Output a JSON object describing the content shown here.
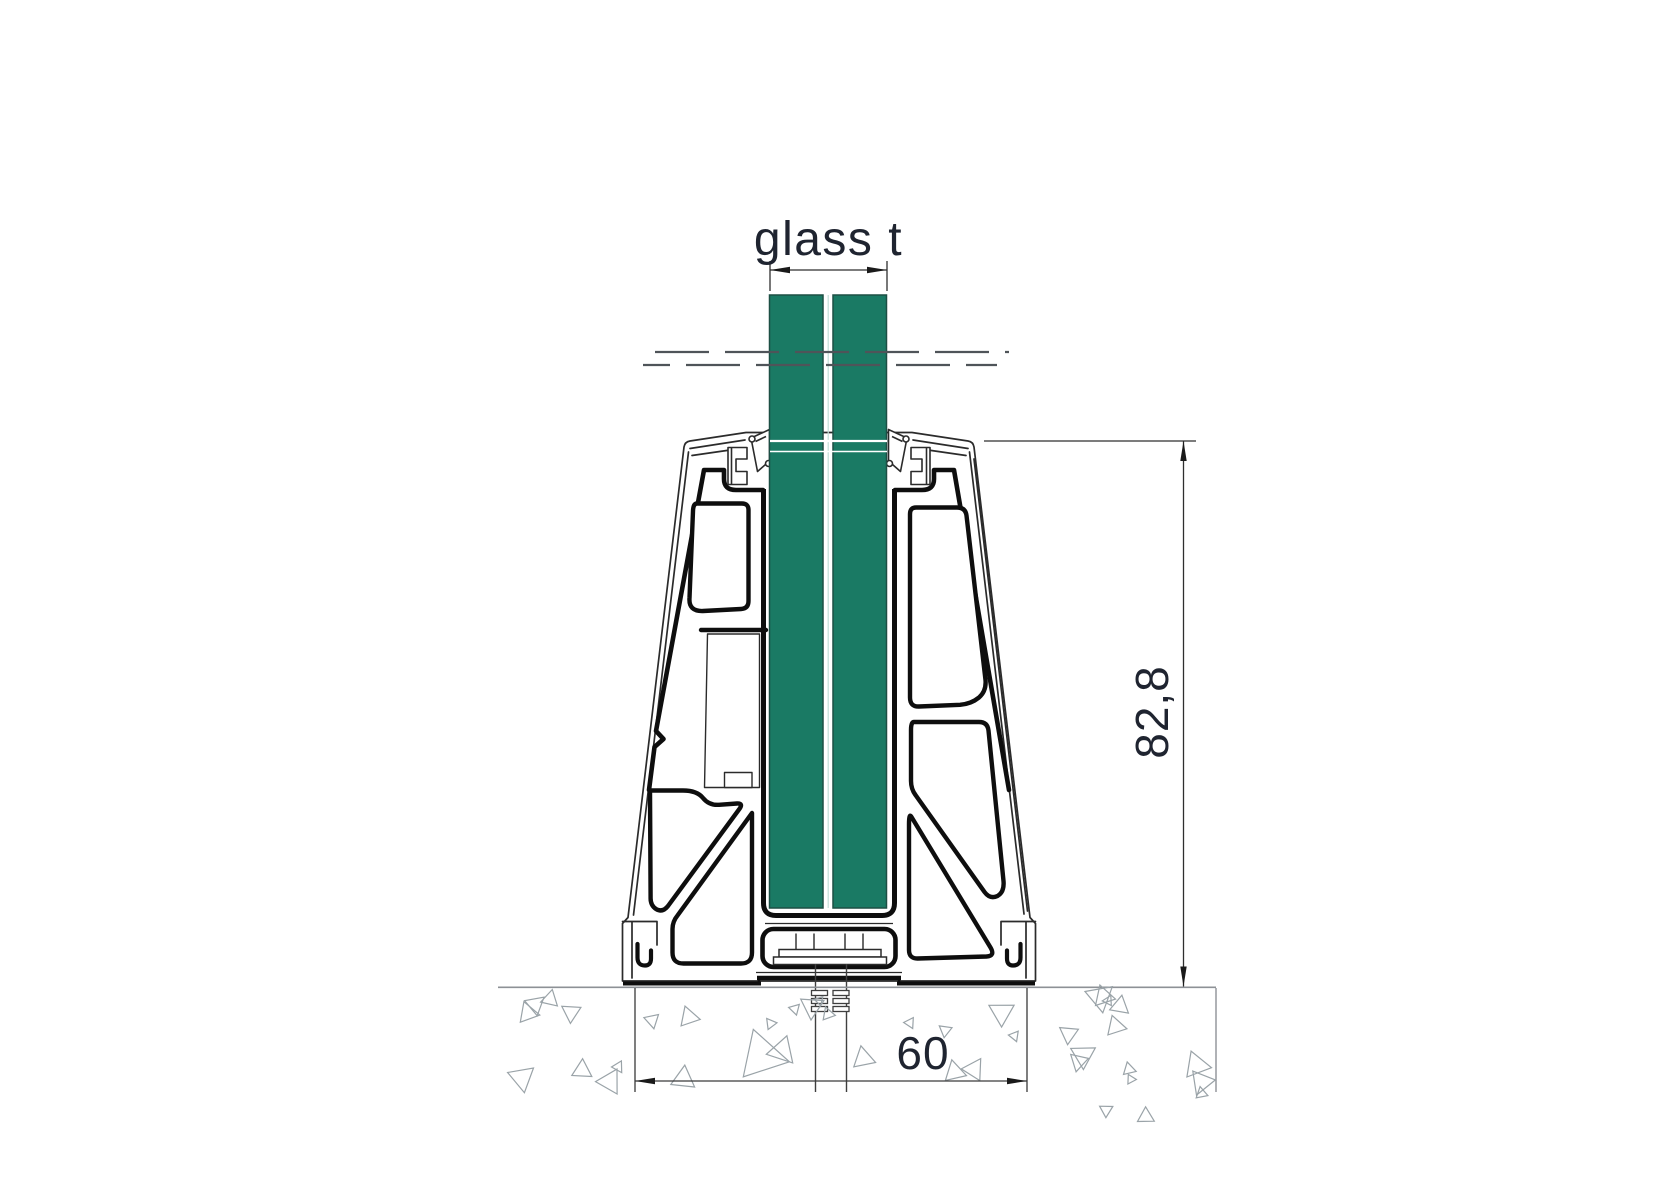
{
  "drawing_labels": {
    "glass_thickness": "glass t",
    "profile_height_mm": "82,8",
    "embed_width_mm": "60"
  },
  "colors": {
    "glass": "#1a7a64",
    "glass_edge": "#1c4f44",
    "interlayer_line": "#c2ded7",
    "outline": "#2b2b2b",
    "outline_heavy": "#0e0e0e",
    "dimension_line": "#2f2f2f",
    "dimension_text": "#1f2430",
    "break_line": "#4f5459",
    "concrete": "#9aa3a8",
    "ground": "#8d9196"
  }
}
